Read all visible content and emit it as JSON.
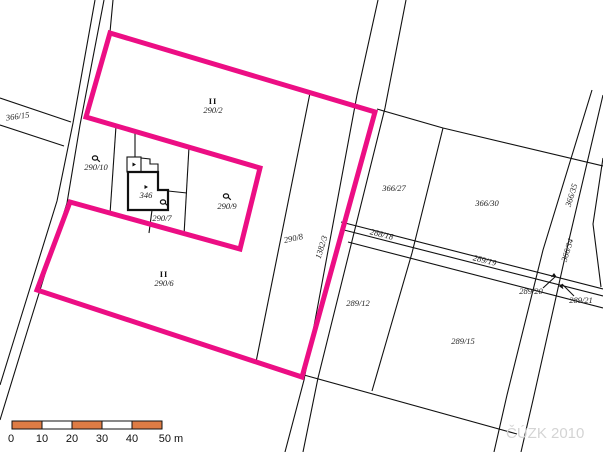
{
  "colors": {
    "highlight": "#ec0e84",
    "line": "#111111",
    "scale_orange": "#de7c45",
    "scale_white": "#ffffff",
    "watermark": "#d4d4d4",
    "background": "#ffffff"
  },
  "labels": {
    "culture_mark": "II",
    "p366_15": "366/15",
    "p290_10": "290/10",
    "p290_2": "290/2",
    "p346": "346",
    "p290_7": "290/7",
    "p290_9": "290/9",
    "p290_6": "290/6",
    "p290_8": "290/8",
    "p1382_3": "1382/3",
    "p366_27": "366/27",
    "p366_30": "366/30",
    "p366_35": "366/35",
    "p366_34": "366/34",
    "p288_18": "288/18",
    "p289_19": "289/19",
    "p289_12": "289/12",
    "p289_15": "289/15",
    "p289_20": "289/20",
    "p289_21": "289/21"
  },
  "scale_bar": {
    "labels": [
      "0",
      "10",
      "20",
      "30",
      "40",
      "50 m"
    ]
  },
  "watermark": "ČÚZK 2010"
}
